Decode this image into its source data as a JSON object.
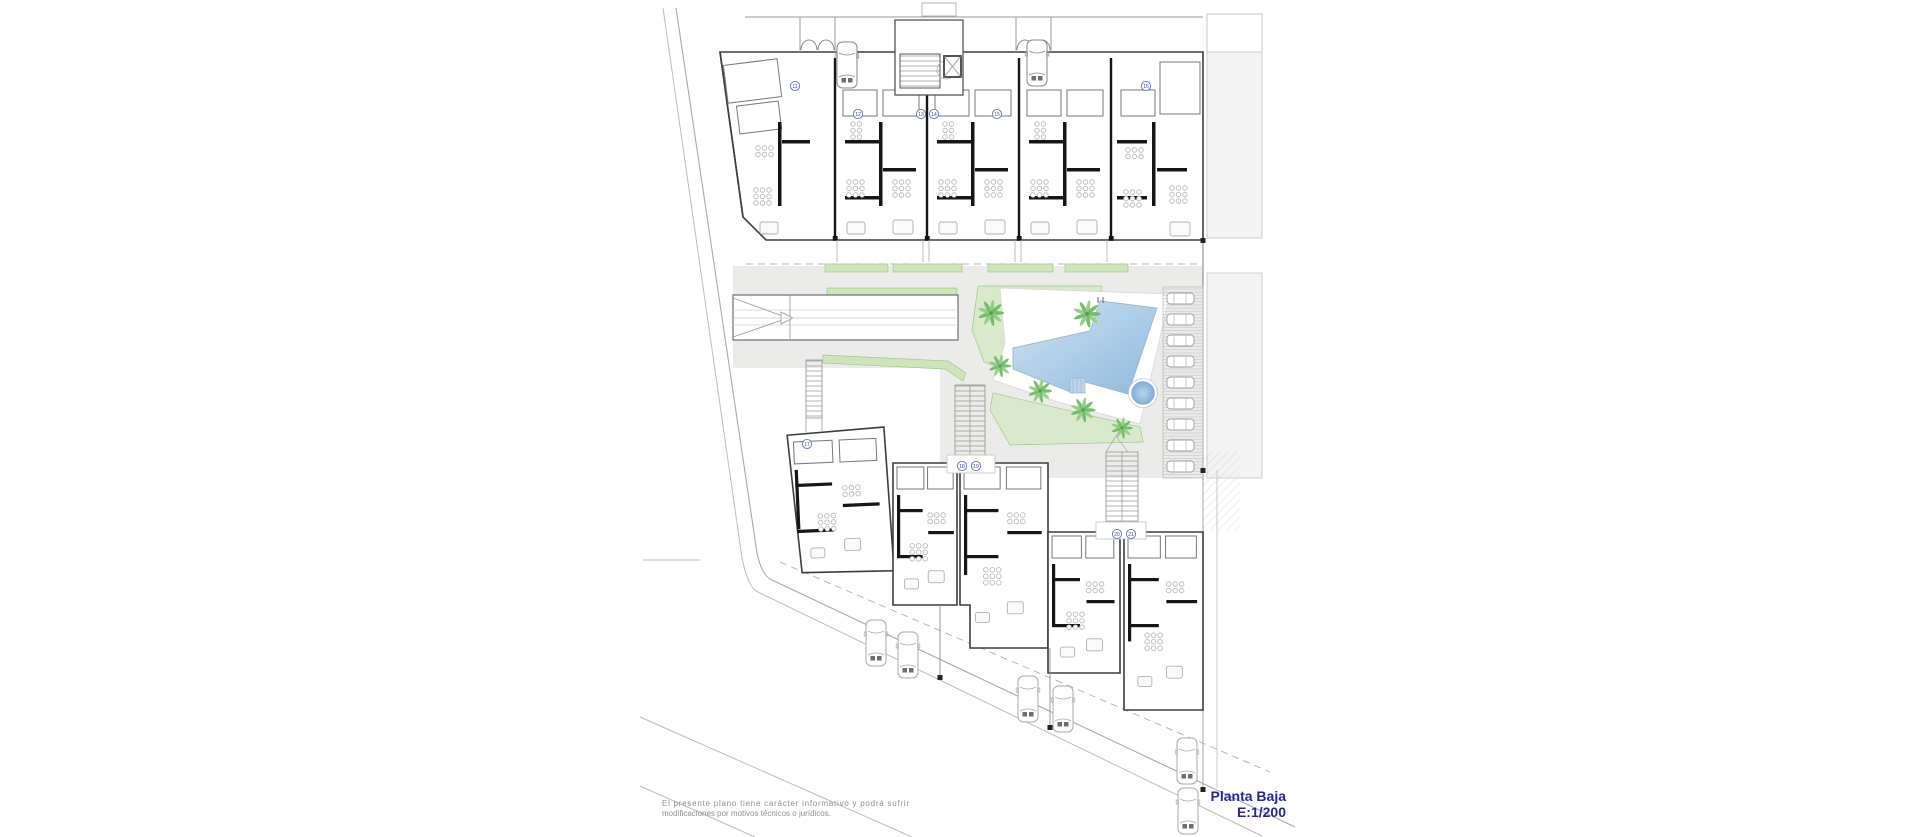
{
  "document": {
    "kind": "architectural-floor-plan",
    "floor_title": "Planta Baja",
    "scale_label": "E:1/200",
    "disclaimer_line1": "El presente plano tiene carácter informativo y podrá sufrir",
    "disclaimer_line2": "modificaciones por motivos técnicos o jurídicos."
  },
  "unit_markers": [
    {
      "label": "11",
      "x": 795,
      "y": 86
    },
    {
      "label": "12",
      "x": 858,
      "y": 114
    },
    {
      "label": "13",
      "x": 921,
      "y": 114
    },
    {
      "label": "14",
      "x": 934,
      "y": 114
    },
    {
      "label": "15",
      "x": 997,
      "y": 114
    },
    {
      "label": "16",
      "x": 1146,
      "y": 86
    },
    {
      "label": "17",
      "x": 807,
      "y": 444
    },
    {
      "label": "18",
      "x": 962,
      "y": 466
    },
    {
      "label": "19",
      "x": 976,
      "y": 466
    },
    {
      "label": "20",
      "x": 1117,
      "y": 534
    },
    {
      "label": "21",
      "x": 1131,
      "y": 534
    }
  ],
  "icons": {
    "pool": "swimming-pool",
    "spa": "round-spa-pool",
    "palm": "palm-tree-icon",
    "car": "car-top-view-icon",
    "stairs": "staircase",
    "ramp": "garage-ramp-arrow",
    "parking": "parking-bays",
    "lawn": "garden-lawn",
    "elevator": "elevator-shaft"
  },
  "colors": {
    "title_blue": "#28288f",
    "pool_light": "#cfe3f3",
    "pool_dark": "#8fb8dc",
    "spa": "#7ca7d1",
    "lawn": "#d8e9cc",
    "green_strip": "#cfe4bb",
    "palm_green": "#6cb963",
    "pavement": "#ebece9",
    "neighbor_gray": "#f3f3f3",
    "wall_black": "#161616",
    "disclaimer_gray": "#8f8f8f"
  }
}
